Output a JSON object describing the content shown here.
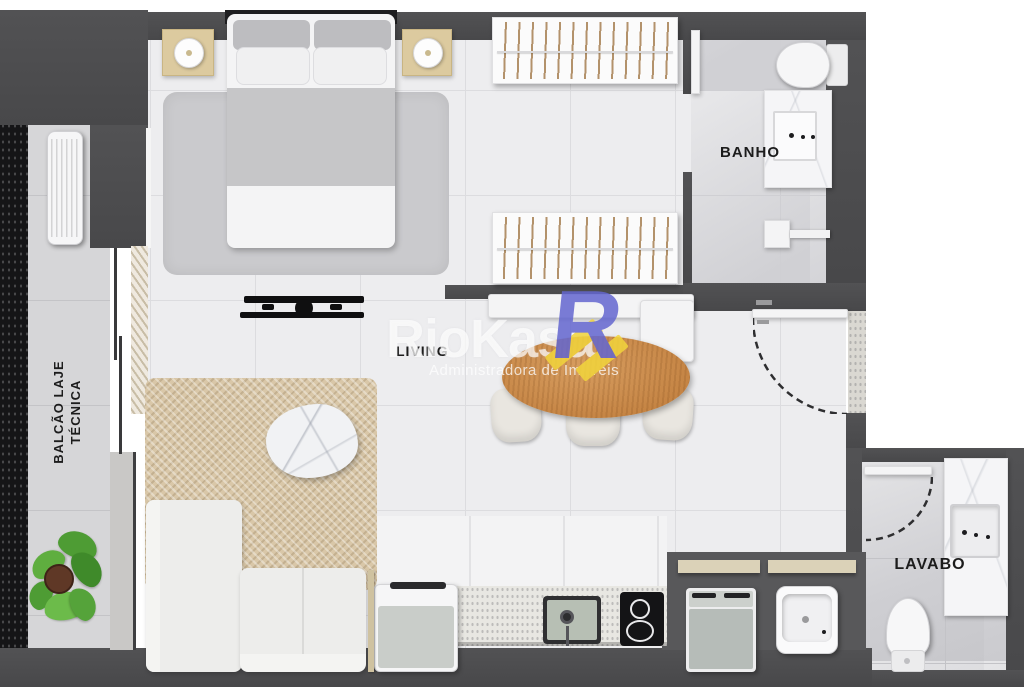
{
  "plan": {
    "labels": {
      "living": "LIVING",
      "banho": "BANHO",
      "lavabo": "LAVABO",
      "balcao_line1": "BALCÃO LAJE",
      "balcao_line2": "TÉCNICA"
    }
  },
  "watermark": {
    "brand": "RioKasa",
    "tagline": "Administradora de Imóveis",
    "logo_letter": "R",
    "logo_blue": "#6467d0",
    "logo_yellow": "#f2d53c"
  },
  "palette": {
    "wall": "#4c4c4e",
    "floor": "#ededef",
    "balcony_floor": "#d6d6d8",
    "wood_table": "#c98a4e",
    "rug_beige": "#d9c7a8",
    "rug_gray": "#cacacd",
    "nightstand": "#dcca9f",
    "shelf": "#dbd2b8",
    "plant_green": "#55a33a",
    "appliance_front": "#b8beba"
  }
}
